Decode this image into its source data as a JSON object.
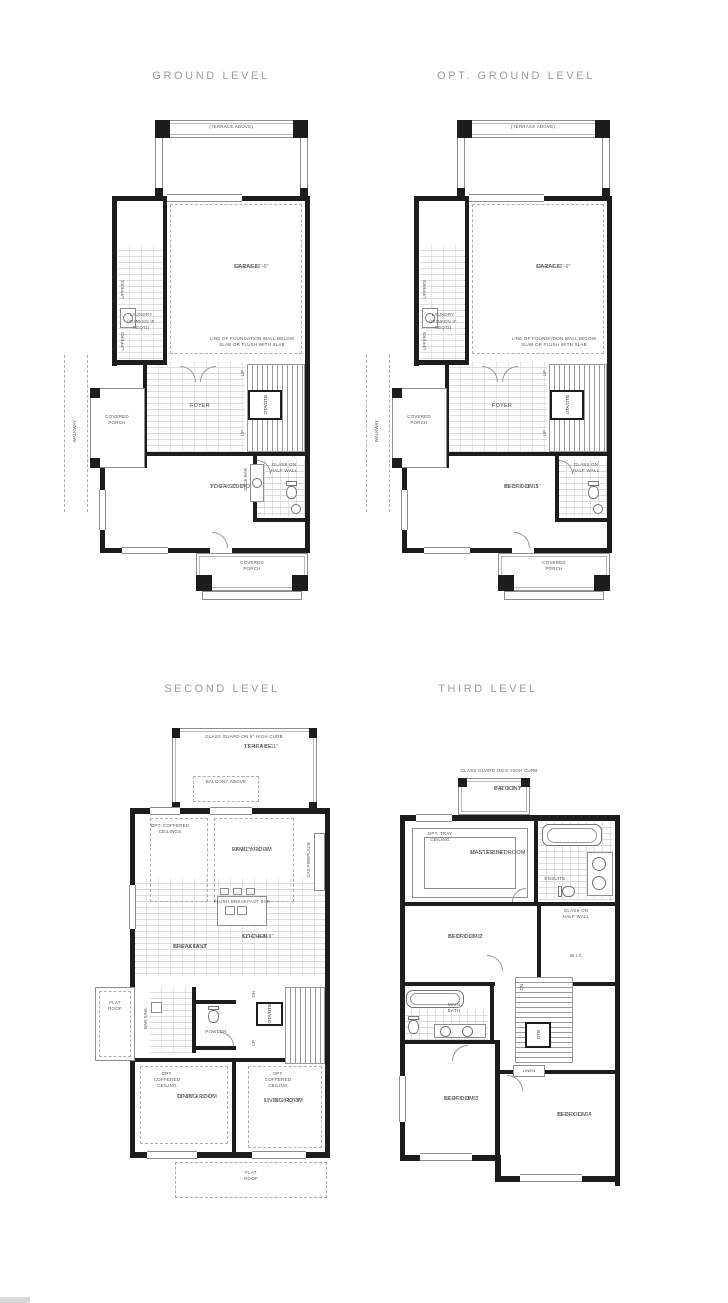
{
  "titles": {
    "ground": "GROUND LEVEL",
    "opt_ground": "OPT. GROUND LEVEL",
    "second": "SECOND LEVEL",
    "third": "THIRD LEVEL"
  },
  "ground": {
    "terrace_above": "(TERRACE ABOVE)",
    "garage_name": "GARAGE",
    "garage_dims": "17'-1\" X 20'-0\"",
    "foundation_note": "LINE OF FOUNDATION WALL BELOW SLAB OR FLUSH WITH SLAB",
    "laundry_name": "LAUNDRY",
    "laundry_note": "(SUNKEN IF REQ'D)",
    "uppers": "UPPERS",
    "covered_porch": "COVERED PORCH",
    "foyer": "FOYER",
    "elevator": "OTA/OTB",
    "up": "UP",
    "walkway": "WALKWAY",
    "yoga_name": "YOGA STUDIO",
    "yoga_dims": "17'-9\" X 12'-0\"",
    "juice_bar": "JUICE BAR",
    "glass_half_wall": "GLASS ON HALF WALL",
    "porch_bottom": "COVERED PORCH"
  },
  "opt_ground": {
    "terrace_above": "(TERRACE ABOVE)",
    "garage_name": "GARAGE",
    "garage_dims": "17'-1\" X 20'-0\"",
    "foundation_note": "LINE OF FOUNDATION WALL BELOW SLAB OR FLUSH WITH SLAB",
    "laundry_name": "LAUNDRY",
    "laundry_note": "(SUNKEN IF REQ'D)",
    "uppers": "UPPERS",
    "covered_porch": "COVERED PORCH",
    "foyer": "FOYER",
    "elevator": "OTA/OTB",
    "up": "UP",
    "walkway": "WALKWAY",
    "bedroom5_name": "BEDROOM 5",
    "bedroom5_dims": "15'-5\" X 11'-11\"",
    "glass_half_wall": "GLASS ON HALF WALL",
    "porch_bottom": "COVERED PORCH"
  },
  "second": {
    "glass_guard": "GLASS GUARD ON 6\" HIGH CURB",
    "terrace_name": "TERRACE",
    "terrace_dims": "17'-4\" X 8'-11\"",
    "balcony_above": "BALCONY ABOVE",
    "opt_coffered_ceilings": "OPT. COFFERED CEILINGS",
    "family_name": "FAMILY ROOM",
    "family_dims": "21'-10\" X 11'-4\"",
    "gas_fireplace": "GAS FIREPLACE",
    "flush_bar": "FLUSH BREAKFAST BAR",
    "kitchen_name": "KITCHEN",
    "kitchen_dims": "12'-4\" X 8'-9\"",
    "breakfast_name": "BREAKFAST",
    "breakfast_dims": "11'-0\" X 13'-0\"",
    "flat_roof": "FLAT ROOF",
    "bar_sink": "BAR SINK",
    "powder": "POWDER",
    "elevator": "OTA/OTB",
    "dn": "DN",
    "up": "UP",
    "opt_coffered_ceiling": "OPT. COFFERED CEILING",
    "dining_name": "DINING ROOM",
    "dining_dims": "11'-10\" X 12'-0\"",
    "living_name": "LIVING ROOM",
    "living_dims": "11'-10\" X 13'-5\"",
    "flat_roof_bottom": "FLAT ROOF"
  },
  "third": {
    "glass_guard": "GLASS GUARD ON 6' HIGH CURB",
    "balcony_name": "BALCONY",
    "balcony_dims": "7'-2\" X 3'-7\"",
    "opt_tray": "OPT. TRAY CEILING",
    "master_name": "MASTER BEDROOM",
    "master_dims": "15'-5\" X 11'-0\"",
    "ensuite": "ENSUITE",
    "glass_half_wall": "GLASS ON HALF WALL",
    "bedroom2_name": "BEDROOM 2",
    "bedroom2_dims": "12'-0\" X 10'-0\"",
    "wic": "W.I.C",
    "main_bath": "MAIN BATH",
    "dn": "DN",
    "otb": "OTB",
    "linen": "LINEN",
    "bedroom3_name": "BEDROOM 3",
    "bedroom3_dims": "12'-4\" X 11'-5\"",
    "bedroom4_name": "BEDROOM 4",
    "bedroom4_dims": "11'-0\" X 11'-1\""
  },
  "colors": {
    "wall": "#1d1d1d",
    "line": "#8f8f8f",
    "text": "#464646",
    "title": "#9e9e9e"
  }
}
